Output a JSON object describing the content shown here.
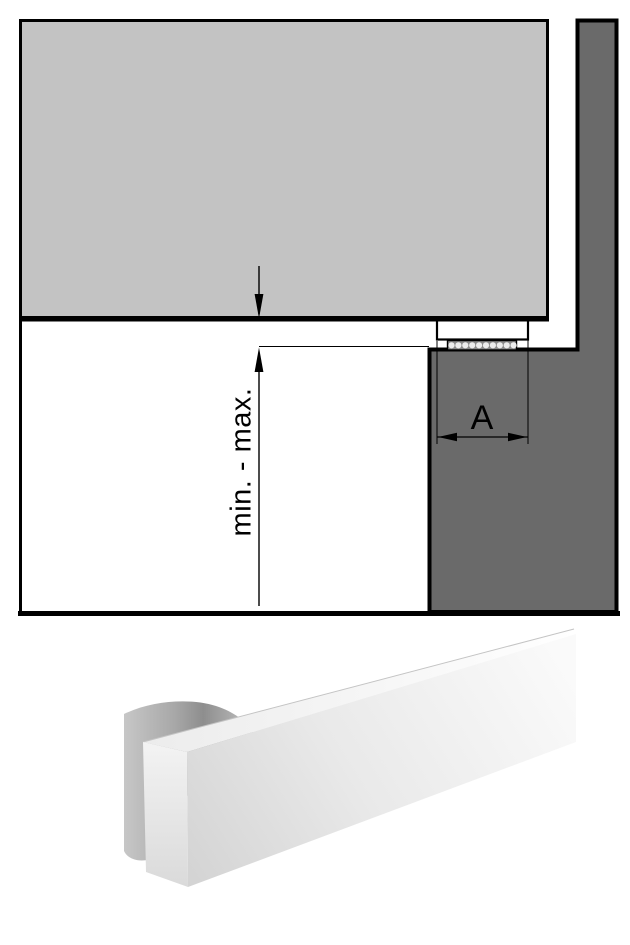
{
  "colors": {
    "page_bg": "#ffffff",
    "ink": "#000000",
    "frame_panel_fill": "#c3c3c3",
    "wall_fill": "#6a6a6a",
    "seal_fill": "#8a8a8a",
    "seal_dot_fill": "#ececec"
  },
  "drawing": {
    "dimension_min_max_label": "min. - max.",
    "dimension_a_label": "A"
  }
}
